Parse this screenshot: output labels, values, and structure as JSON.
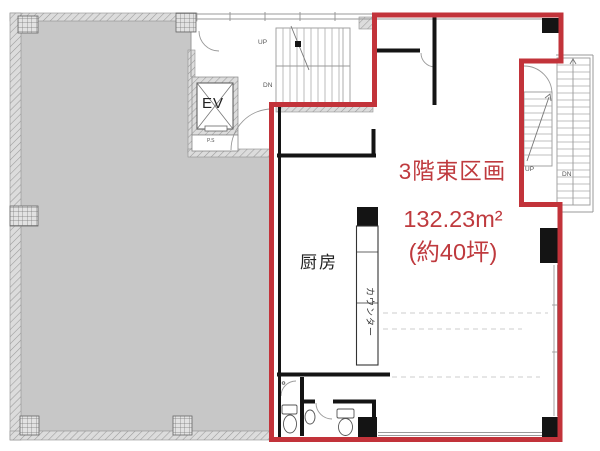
{
  "unit": {
    "name": "3階東区画",
    "area_sqm": "132.23m²",
    "area_tsubo": "(約40坪)"
  },
  "rooms": {
    "kitchen": "厨房",
    "counter": "カウンター"
  },
  "facilities": {
    "elevator": "EV",
    "pipe_space": "P.S"
  },
  "stairs": {
    "up": "UP",
    "down": "DN"
  },
  "colors": {
    "boundary_red": "#c2333a",
    "text_red": "#bf3a3e",
    "neighbor_gray": "#c7c7c7",
    "wall_black": "#141414"
  }
}
